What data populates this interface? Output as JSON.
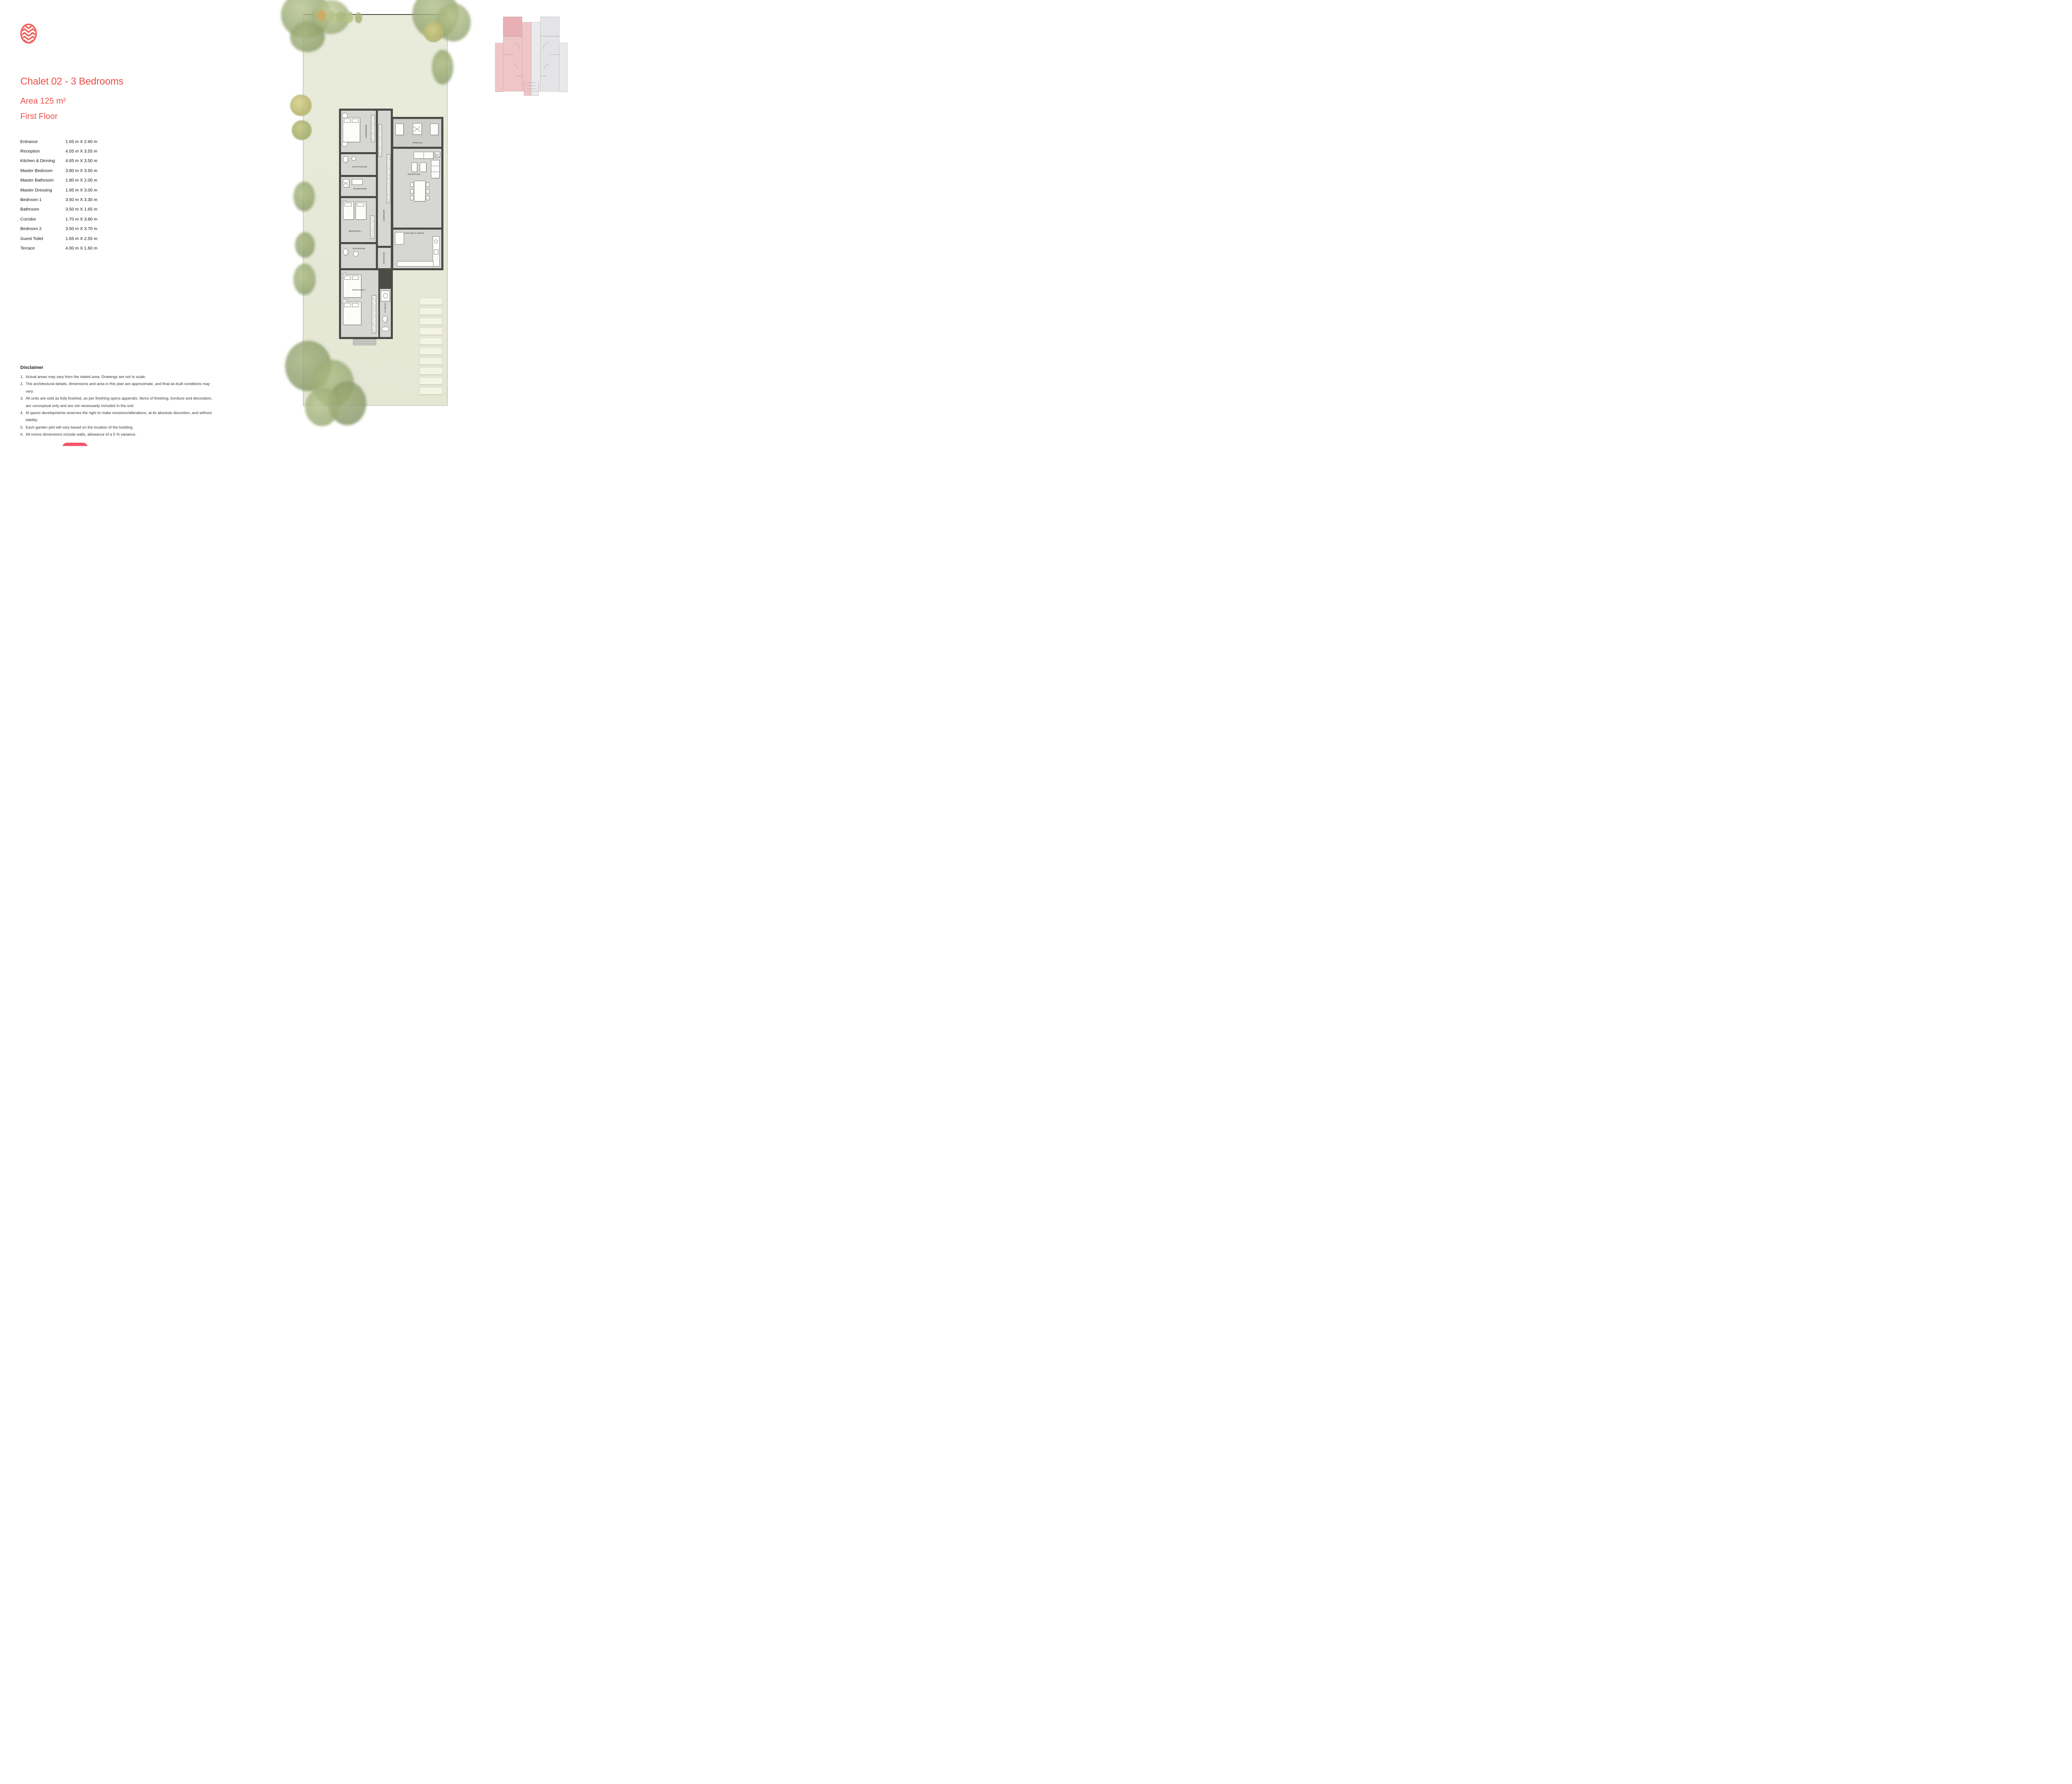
{
  "header": {
    "title": "Chalet 02 - 3 Bedrooms",
    "area": "Area 125 m²",
    "floor": "First Floor",
    "accent_color": "#ee4f47"
  },
  "brand": {
    "logo_icon": "zigzag-oval-logo",
    "logo_color": "#ef6059"
  },
  "dimensions": {
    "rows": [
      {
        "room": "Entrance",
        "size": "1.65 m X 2.60 m"
      },
      {
        "room": "Reception",
        "size": "4.05 m X 3.55 m"
      },
      {
        "room": "Kitchen & Dinning",
        "size": "4.65 m X 3.50 m"
      },
      {
        "room": "Master Bedroom",
        "size": "3.80 m X 3.50 m"
      },
      {
        "room": "Master Bathroom",
        "size": "1.80 m X 2.00 m"
      },
      {
        "room": "Master Dressing",
        "size": "1.95 m X 3.00 m"
      },
      {
        "room": "Bedroom 1",
        "size": "3.50 m X 3.30 m"
      },
      {
        "room": "Bathroom",
        "size": "3.50 m X 1.65 m"
      },
      {
        "room": "Corridor",
        "size": "1.70 m X 3.80 m"
      },
      {
        "room": "Bedroom 2",
        "size": "3.50 m X 3.70 m"
      },
      {
        "room": "Guest Toilet",
        "size": "1.65 m X 2.55 m"
      },
      {
        "room": "Terrace",
        "size": "4.00 m X 1.60 m"
      }
    ]
  },
  "disclaimer": {
    "heading": "Disclaimer",
    "items": [
      {
        "num": "1.",
        "text": "Actual areas may vary from the stated area. Drawings are not to scale."
      },
      {
        "num": "2.",
        "text": "The architectural details, dimensions and area in this plan are approximate, and final as-built conditions may vary."
      },
      {
        "num": "3.",
        "text": "All units are sold as fully finished, as per finishing specs appendix.  Items of finishing, furniture and decoration,\nare conceptual only and are not necessarily included in the unit."
      },
      {
        "num": "4.",
        "text": "Al qamzi developments reserves the right to make revisions/alterations, at its absolute discretion, and without liability."
      },
      {
        "num": "5.",
        "text": "Each garden plot will vary based on the location of the building."
      },
      {
        "num": "6.",
        "text": "All rooms dimensions include walls, allowance of a 5 % variance."
      }
    ]
  },
  "plan": {
    "labels": {
      "master_bedroom": "M.BEDROOM",
      "terrace": "TERRACE",
      "m_bathroom": "M.BATHROOM",
      "m_dressing": "M.DRESSING",
      "reception": "RECEPTION",
      "bedroom_1": "BEDROOM 1",
      "corridor": "CORRIDOR",
      "kitchen_dining": "KITCHEN & DINING",
      "bathroom": "BATHROOM",
      "entrance": "ENTRANCE",
      "bedroom_2": "BEDROOM 2",
      "guest_toilet": "G.TOILET"
    },
    "wall_color": "#4c4b47",
    "floor_color": "#d6d6d3",
    "garden_color": "#e8ead9"
  },
  "keyplan": {
    "highlight_color": "#f0c5c7",
    "highlight_dark": "#e9b0b3",
    "muted_color": "#e4e4e6"
  },
  "action_button": {
    "color": "#f2546c"
  }
}
